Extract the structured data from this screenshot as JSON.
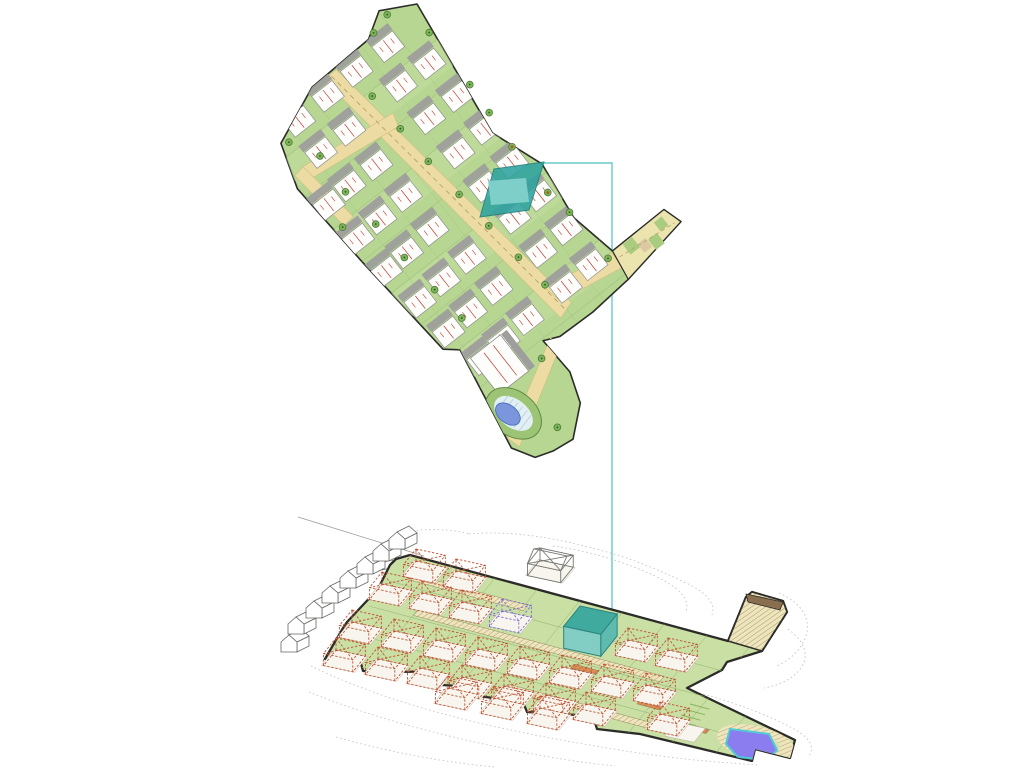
{
  "image": {
    "kind": "architectural-masterplan-drawing",
    "views": [
      "site-plan-top-view",
      "axonometric-terrain-view"
    ],
    "width": 1024,
    "height": 768
  },
  "colors": {
    "background": "#ffffff",
    "outline": "#2b2b28",
    "plan_green": "#b6d692",
    "plan_row_light": "#c3de9f",
    "plan_grid": "#9bbb77",
    "road_tan": "#ecdca4",
    "road_dash": "#b39a5e",
    "driveway_gray": "#9e9e9c",
    "house_white": "#fdfdfc",
    "house_edge": "#8f8f8c",
    "red_line": "#c23b30",
    "tree_fill": "#7cb55a",
    "tree_edge": "#4d7a35",
    "tree_dot": "#2f5a1e",
    "tree_dot_orange": "#b05818",
    "teal_fill": "#2fa3a0",
    "teal_house": "#82d1cc",
    "teal_edge": "#1d7d7a",
    "link_line": "#6ac9cb",
    "iso_green": "#c9dfa4",
    "iso_grid": "#96b475",
    "hatch_fill": "#eee5bd",
    "hatch_line": "#84744a",
    "wire_red": "#c05231",
    "wire_purple": "#7e6bd0",
    "slab": "#f7f5ee",
    "slab_edge": "#bcb6a8",
    "context_line": "#666663",
    "contour": "#cbc5bc",
    "pool_blue_plan": "#7b96dd",
    "pool_blue_edge": "#4a6fc0",
    "pool_deck": "#e2f0f4",
    "pool_deck_stripe": "#b8d4de",
    "pool_ring": "#9cc474",
    "pool_ring_edge": "#5f8a40",
    "pool_3d": "#8b7cf0",
    "pool_3d_rim": "#4ec9d6",
    "road_dark": "#8a6f4e",
    "arm_fill": "#ece4ae",
    "arm_patch_green": "#a9cc80",
    "arm_patch_beige": "#dcc9a4",
    "accent_orange": "#dd8a55",
    "lawn_line": "#86b45e"
  },
  "plan": {
    "origin": [
      417,
      4
    ],
    "rotation": 52,
    "boundary": [
      [
        0,
        0
      ],
      [
        148,
        20
      ],
      [
        203,
        0
      ],
      [
        265,
        8
      ],
      [
        315,
        -2
      ],
      [
        314,
        -68
      ],
      [
        334,
        -74
      ],
      [
        347,
        3
      ],
      [
        351,
        51
      ],
      [
        350,
        92
      ],
      [
        343,
        108
      ],
      [
        384,
        106
      ],
      [
        415,
        117
      ],
      [
        439,
        145
      ],
      [
        436,
        168
      ],
      [
        430,
        186
      ],
      [
        408,
        199
      ],
      [
        299,
        179
      ],
      [
        288,
        192
      ],
      [
        169,
        202
      ],
      [
        72,
        208
      ],
      [
        26,
        193
      ],
      [
        1,
        134
      ],
      [
        -2,
        60
      ],
      [
        -18,
        34
      ]
    ],
    "arm_polygon": [
      [
        315,
        -2
      ],
      [
        314,
        -68
      ],
      [
        334,
        -74
      ],
      [
        347,
        3
      ]
    ],
    "arm_patches_green": [
      [
        316,
        -26,
        13,
        12
      ],
      [
        328,
        -48,
        13,
        11
      ],
      [
        318,
        -62,
        11,
        10
      ]
    ],
    "arm_patches_beige": [
      [
        325,
        -36,
        11,
        10
      ]
    ],
    "arm_dash": [
      [
        324,
        -4
      ],
      [
        331,
        -68
      ]
    ],
    "roads": [
      [
        [
          2,
          104
        ],
        [
          330,
          62
        ],
        [
          336,
          80
        ],
        [
          2,
          120
        ]
      ],
      [
        [
          302,
          74
        ],
        [
          316,
          0
        ],
        [
          334,
          0
        ],
        [
          322,
          70
        ]
      ],
      [
        [
          345,
          100
        ],
        [
          358,
          98
        ],
        [
          412,
          192
        ],
        [
          398,
          196
        ]
      ],
      [
        [
          71,
          86
        ],
        [
          85,
          90
        ],
        [
          72,
          194
        ],
        [
          58,
          190
        ]
      ],
      [
        [
          58,
          190
        ],
        [
          128,
          181
        ],
        [
          130,
          194
        ],
        [
          60,
          202
        ]
      ]
    ],
    "road_center_dash": [
      [
        4,
        112
      ],
      [
        333,
        71
      ]
    ],
    "row_strips": [
      2,
      45,
      88,
      131,
      174,
      217,
      260,
      303
    ],
    "grid_cols": [
      40,
      83,
      126,
      169,
      212,
      255,
      298,
      341
    ],
    "grid_col_range": [
      -5,
      210
    ],
    "grid_rows": [
      35,
      70,
      105,
      140,
      175
    ],
    "grid_row_range": [
      -15,
      352
    ],
    "house_size": [
      20,
      26
    ],
    "houses": [
      [
        6,
        36
      ],
      [
        6,
        76
      ],
      [
        8,
        114
      ],
      [
        10,
        152
      ],
      [
        45,
        14
      ],
      [
        45,
        50
      ],
      [
        48,
        118
      ],
      [
        48,
        154
      ],
      [
        88,
        12
      ],
      [
        88,
        48
      ],
      [
        92,
        118
      ],
      [
        92,
        152
      ],
      [
        94,
        180
      ],
      [
        131,
        10
      ],
      [
        133,
        46
      ],
      [
        135,
        114
      ],
      [
        137,
        148
      ],
      [
        139,
        178
      ],
      [
        174,
        10
      ],
      [
        176,
        46
      ],
      [
        178,
        114
      ],
      [
        180,
        148
      ],
      [
        182,
        176
      ],
      [
        217,
        8
      ],
      [
        219,
        42
      ],
      [
        223,
        102
      ],
      [
        225,
        136
      ],
      [
        227,
        168
      ],
      [
        260,
        8
      ],
      [
        262,
        42
      ],
      [
        264,
        100
      ],
      [
        266,
        134
      ],
      [
        268,
        164
      ],
      [
        303,
        10
      ],
      [
        305,
        44
      ],
      [
        307,
        94
      ],
      [
        309,
        126
      ],
      [
        311,
        154
      ]
    ],
    "big_building": {
      "rect": [
        312,
        138,
        46,
        38
      ],
      "band": [
        312,
        130,
        46,
        7
      ]
    },
    "pool": {
      "center": [
        382,
        176
      ],
      "rotate": -14,
      "ring_r": [
        31,
        22
      ],
      "deck_r": [
        22,
        14
      ],
      "pool_r": [
        14,
        9
      ],
      "pool_offset": [
        -4,
        4
      ],
      "stripes": 6
    },
    "trees": [
      [
        30,
        8,
        "g"
      ],
      [
        96,
        8,
        "g"
      ],
      [
        130,
        10,
        "g"
      ],
      [
        171,
        13,
        "o"
      ],
      [
        229,
        13,
        "o"
      ],
      [
        258,
        8,
        "g"
      ],
      [
        318,
        6,
        "g"
      ],
      [
        -10,
        30,
        "g"
      ],
      [
        -4,
        52,
        "g"
      ],
      [
        45,
        92,
        "g"
      ],
      [
        88,
        90,
        "g"
      ],
      [
        131,
        88,
        "g"
      ],
      [
        176,
        84,
        "g"
      ],
      [
        219,
        80,
        "g"
      ],
      [
        262,
        76,
        "g"
      ],
      [
        300,
        72,
        "g"
      ],
      [
        60,
        170,
        "g"
      ],
      [
        104,
        172,
        "g"
      ],
      [
        148,
        168,
        "g"
      ],
      [
        192,
        166,
        "g"
      ],
      [
        236,
        162,
        "g"
      ],
      [
        275,
        158,
        "g"
      ],
      [
        30,
        186,
        "g"
      ],
      [
        130,
        196,
        "g"
      ],
      [
        356,
        120,
        "g"
      ],
      [
        420,
        150,
        "g"
      ]
    ]
  },
  "highlight": {
    "plot_polygon": [
      [
        494,
        169
      ],
      [
        544,
        162
      ],
      [
        529,
        210
      ],
      [
        480,
        217
      ]
    ],
    "house_polygon": [
      [
        488,
        181
      ],
      [
        526,
        178
      ],
      [
        529,
        202
      ],
      [
        491,
        205
      ]
    ],
    "link_polyline": [
      [
        544,
        163
      ],
      [
        612,
        163
      ],
      [
        612,
        614
      ]
    ]
  },
  "iso": {
    "u": [
      0.978,
      0.21
    ],
    "ug": [
      0.965,
      0.26
    ],
    "v": [
      -0.627,
      0.779
    ],
    "platform": [
      [
        410,
        555
      ],
      [
        728,
        641
      ],
      [
        746,
        597
      ],
      [
        752,
        592
      ],
      [
        783,
        601
      ],
      [
        787,
        612
      ],
      [
        762,
        651
      ],
      [
        727,
        662
      ],
      [
        722,
        670
      ],
      [
        687,
        688
      ],
      [
        795,
        740
      ],
      [
        790,
        758
      ],
      [
        755,
        749
      ],
      [
        752,
        761
      ],
      [
        640,
        734
      ],
      [
        597,
        729
      ],
      [
        593,
        716
      ],
      [
        527,
        712
      ],
      [
        523,
        702
      ],
      [
        478,
        696
      ],
      [
        477,
        687
      ],
      [
        423,
        684
      ],
      [
        420,
        672
      ],
      [
        363,
        671
      ],
      [
        360,
        660
      ],
      [
        325,
        659
      ],
      [
        343,
        628
      ],
      [
        347,
        622
      ],
      [
        377,
        590
      ],
      [
        380,
        585
      ],
      [
        390,
        565
      ],
      [
        396,
        559
      ]
    ],
    "grid_u_starts": [
      [
        389,
        581
      ],
      [
        369,
        606
      ],
      [
        348,
        632
      ],
      [
        327,
        658
      ]
    ],
    "grid_u_len": 470,
    "grid_v_count": 9,
    "grid_v_step": 44,
    "grid_v_len": 175,
    "hatch_bands": [
      [
        412,
        574,
        120,
        7
      ],
      [
        418,
        610,
        255,
        7
      ],
      [
        508,
        684,
        170,
        7
      ]
    ],
    "accent_bands": [
      [
        430,
        647,
        26,
        5
      ],
      [
        574,
        664,
        26,
        5
      ],
      [
        640,
        700,
        24,
        5
      ],
      [
        688,
        724,
        22,
        5
      ]
    ],
    "arm_polygon": [
      [
        728,
        641
      ],
      [
        746,
        597
      ],
      [
        752,
        592
      ],
      [
        783,
        601
      ],
      [
        787,
        612
      ],
      [
        762,
        651
      ]
    ],
    "arm_road": [
      [
        746,
        594
      ],
      [
        783,
        602
      ],
      [
        780,
        610
      ],
      [
        748,
        602
      ]
    ],
    "house_w": 30,
    "house_d": 20,
    "house_h": 12,
    "houses": [
      [
        416,
        561
      ],
      [
        456,
        571
      ],
      [
        382,
        584
      ],
      [
        422,
        593
      ],
      [
        462,
        602
      ],
      [
        502,
        611,
        "p"
      ],
      [
        628,
        640
      ],
      [
        668,
        650
      ],
      [
        352,
        622
      ],
      [
        394,
        631
      ],
      [
        436,
        640
      ],
      [
        478,
        649
      ],
      [
        520,
        658
      ],
      [
        562,
        667
      ],
      [
        604,
        676
      ],
      [
        646,
        685
      ],
      [
        336,
        650
      ],
      [
        378,
        659
      ],
      [
        420,
        668
      ],
      [
        462,
        677
      ],
      [
        504,
        686
      ],
      [
        546,
        695
      ],
      [
        586,
        704
      ],
      [
        448,
        688
      ],
      [
        494,
        698
      ],
      [
        540,
        708
      ],
      [
        660,
        714
      ]
    ],
    "teal_box": {
      "p": [
        580,
        628
      ],
      "w": 38,
      "d": 26,
      "h": 22
    },
    "lone_house": {
      "p": [
        540,
        560
      ],
      "w": 34,
      "d": 20,
      "h": 12
    },
    "context_houses": [
      [
        281,
        640
      ],
      [
        288,
        622
      ],
      [
        306,
        606
      ],
      [
        322,
        591
      ],
      [
        340,
        576
      ],
      [
        357,
        562
      ],
      [
        373,
        549
      ],
      [
        389,
        537
      ]
    ],
    "road_line": [
      [
        298,
        517
      ],
      [
        424,
        556
      ]
    ],
    "marker_box": [
      [
        380,
        563
      ],
      [
        392,
        560
      ],
      [
        394,
        567
      ],
      [
        382,
        570
      ]
    ],
    "pool": {
      "hatch_ellipse": [
        756,
        743,
        40,
        17,
        13
      ],
      "lawn_ellipse": [
        753,
        742,
        27,
        11,
        13
      ],
      "pool_polygon": [
        [
          730,
          729
        ],
        [
          769,
          734
        ],
        [
          777,
          750
        ],
        [
          768,
          760
        ],
        [
          738,
          757
        ],
        [
          726,
          744
        ]
      ]
    },
    "pool_slab": [
      676,
      722,
      30,
      18
    ],
    "lawn_lines": {
      "start": [
        690,
        704
      ],
      "count": 6,
      "len": 20,
      "gap": 7
    },
    "contours": [
      "M 469,534 C 510,530 555,538 592,548 C 628,557 655,568 686,583 C 706,592 716,603 712,615",
      "M 553,546 C 590,551 625,562 655,576 C 678,587 690,598 686,611",
      "M 779,593 C 800,602 812,618 806,636 C 801,650 790,660 777,666",
      "M 788,629 C 804,641 810,655 801,668 C 793,679 780,685 764,688",
      "M 311,666 C 360,690 425,711 492,726 C 556,740 615,750 668,757 C 700,761 730,763 757,765",
      "M 309,692 C 368,716 438,735 512,750 C 552,758 585,763 615,766",
      "M 336,737 C 392,753 444,762 494,767",
      "M 691,691 C 728,700 764,713 794,729 C 810,738 816,748 808,757",
      "M 404,532 C 430,528 452,529 470,534"
    ]
  }
}
